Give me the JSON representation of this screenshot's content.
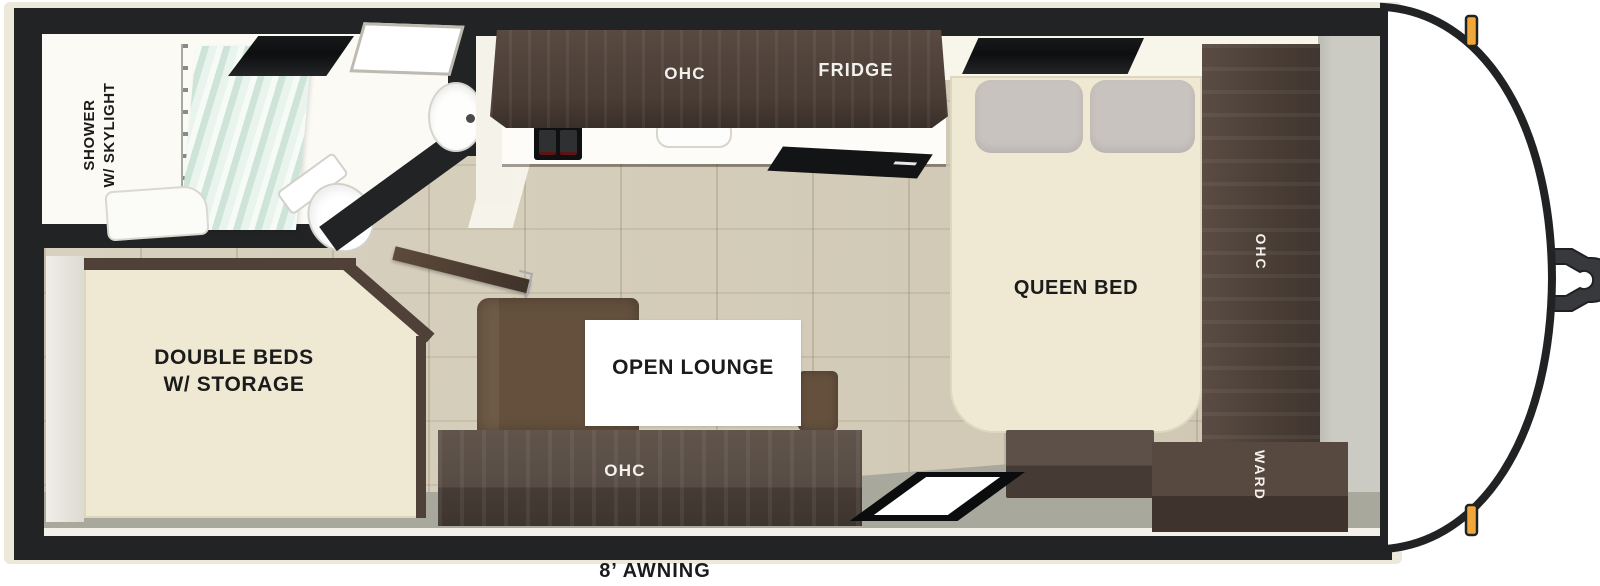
{
  "floorplan": {
    "bathroom": {
      "shower_label_line1": "SHOWER",
      "shower_label_line2": "W/ SKYLIGHT"
    },
    "kitchen": {
      "overhead_cabinet_label": "OHC",
      "fridge_label": "FRIDGE"
    },
    "bedroom": {
      "bed_label": "QUEEN BED",
      "overhead_cabinet_label": "OHC",
      "wardrobe_label": "WARD"
    },
    "bunk_room": {
      "label_line1": "DOUBLE BEDS",
      "label_line2": "W/ STORAGE"
    },
    "lounge": {
      "label": "OPEN LOUNGE",
      "overhead_cabinet_label": "OHC"
    },
    "exterior": {
      "awning_label": "8’ AWNING"
    },
    "colors": {
      "wall_black": "#212324",
      "exterior_cream": "#ece8da",
      "cabinet_brown": "#4a3d35",
      "floor_wood": "#d3cbb7",
      "floor_gray": "#a9a89d",
      "bed_cream": "#efe9d4",
      "sofa_brown": "#64503d",
      "curtain_mint": "#cfe4d8",
      "marker_light_amber": "#f1a83a"
    }
  }
}
